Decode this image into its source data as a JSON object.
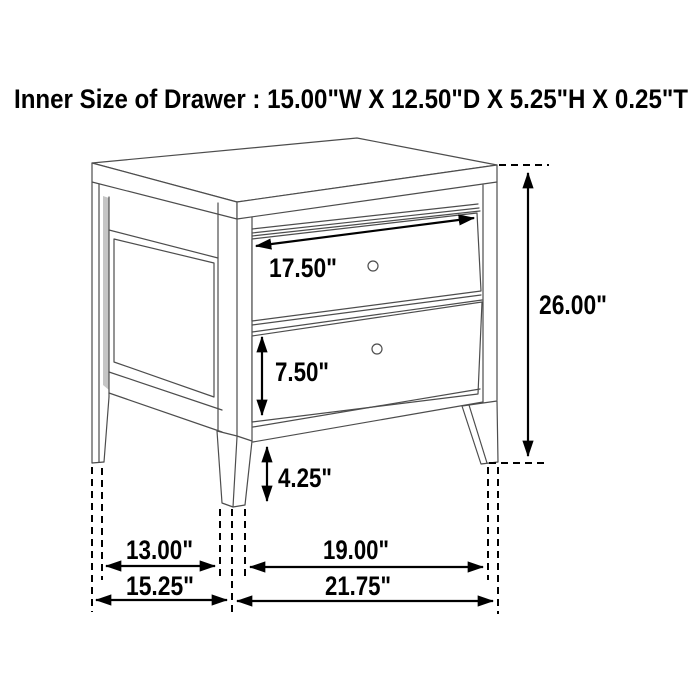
{
  "title": {
    "text": "Inner Size of Drawer : 15.00\"W X 12.50\"D X 5.25\"H X 0.25\"T"
  },
  "diagram": {
    "type": "furniture-dimension-diagram",
    "subject": "two-drawer nightstand, three-quarter perspective line drawing",
    "units": "inches",
    "labels": {
      "drawer_width": "17.50\"",
      "overall_height": "26.00\"",
      "drawer_front_height": "7.50\"",
      "floor_clearance": "4.25\"",
      "side_inner_span": "13.00\"",
      "front_inner_span": "19.00\"",
      "overall_depth": "15.25\"",
      "overall_width": "21.75\""
    },
    "inner_drawer_size": {
      "width_in": 15.0,
      "depth_in": 12.5,
      "height_in": 5.25,
      "thickness_in": 0.25
    },
    "dimensions_in": {
      "drawer_front_width": 17.5,
      "overall_height": 26.0,
      "drawer_front_height": 7.5,
      "floor_clearance": 4.25,
      "side_inner_span": 13.0,
      "front_inner_span": 19.0,
      "overall_depth": 15.25,
      "overall_width": 21.75
    },
    "colors": {
      "line": "#4d4d4d",
      "dimension": "#000000",
      "background": "#ffffff",
      "shade": "#c5c5c5"
    }
  }
}
